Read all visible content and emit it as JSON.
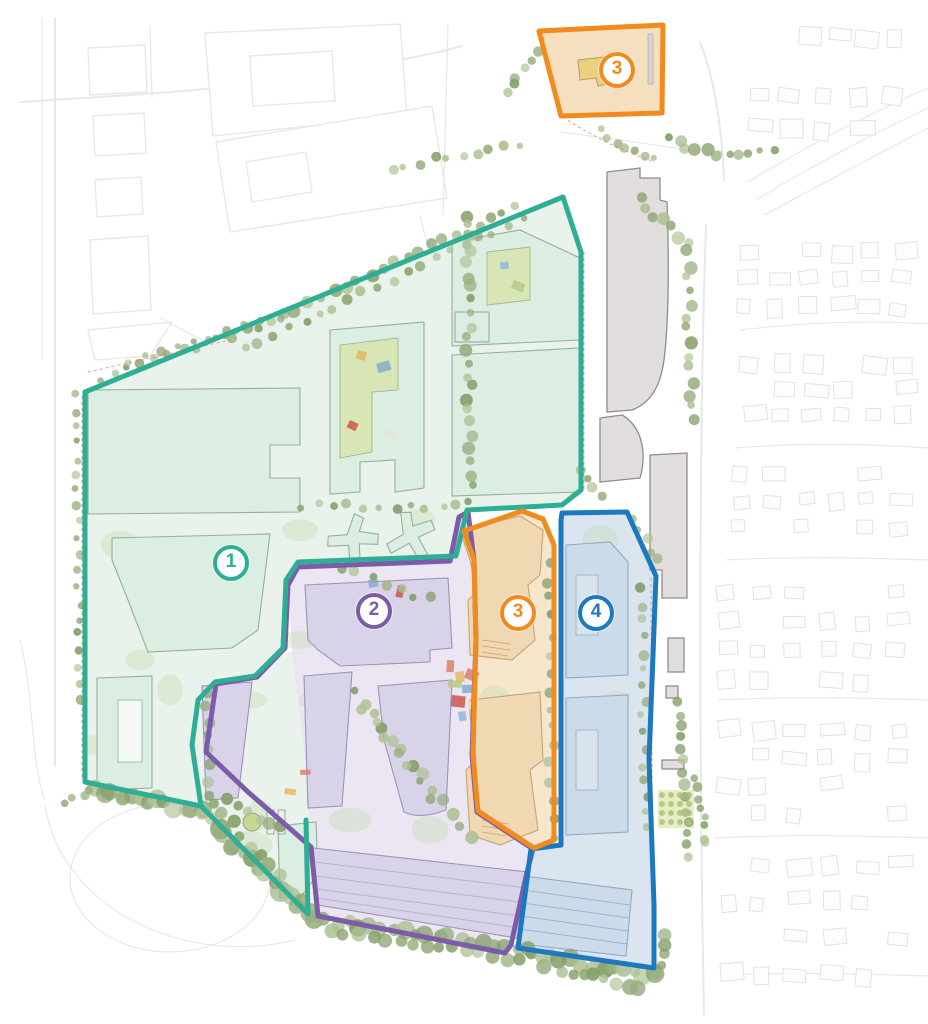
{
  "map": {
    "type": "illustrated-campus-master-plan",
    "zones": [
      {
        "id": "zone-1",
        "label": "1",
        "color": "#2fae96",
        "fill": "#dcede2"
      },
      {
        "id": "zone-2",
        "label": "2",
        "color": "#7c5ca8",
        "fill": "#d9d3e9"
      },
      {
        "id": "zone-3",
        "label": "3",
        "color": "#f28b1d",
        "fill": "#efd8b2",
        "badge_locations": [
          "north-site",
          "central-site"
        ]
      },
      {
        "id": "zone-4",
        "label": "4",
        "color": "#1c79c0",
        "fill": "#cbdbea"
      }
    ],
    "palette": {
      "road": "#e8e8e8",
      "house": "#e2e2e2",
      "tree1": "#9aaf80",
      "tree2": "#87a06b",
      "tree3": "#afc296",
      "foliage": "#c9dcb5",
      "gray_building": "#e1dedd",
      "gray_stroke": "#8d8d8d",
      "red_dash": "#d9705a",
      "ground1": "#e7f2e9",
      "ground2": "#e7e2f0",
      "ground3": "#f5e3c6",
      "ground4": "#d7e2ee",
      "ground3_top": "#f6dfbf"
    }
  }
}
